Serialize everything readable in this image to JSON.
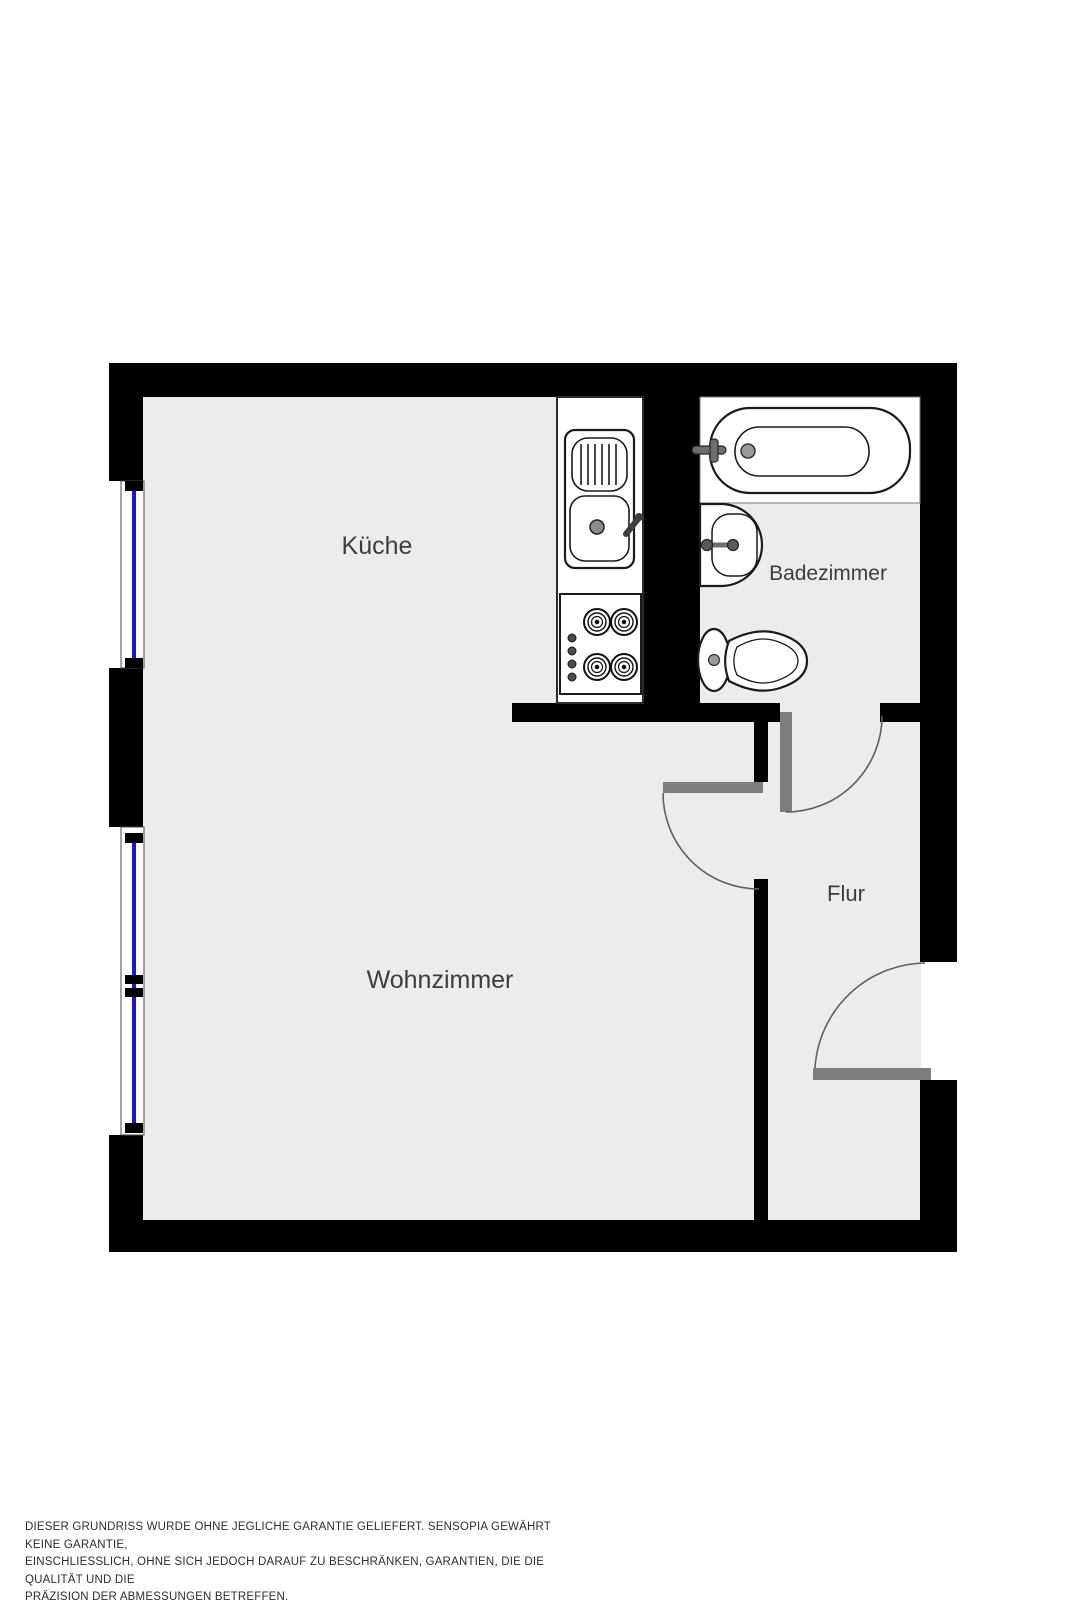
{
  "floorplan": {
    "rooms": [
      {
        "id": "kueche",
        "label": "Küche"
      },
      {
        "id": "badezimmer",
        "label": "Badezimmer"
      },
      {
        "id": "wohnzimmer",
        "label": "Wohnzimmer"
      },
      {
        "id": "flur",
        "label": "Flur"
      }
    ],
    "fixtures": [
      "bathtub",
      "bathroom-washbasin",
      "toilet",
      "kitchen-counter",
      "kitchen-sink-with-drainboard",
      "stove-4-burners"
    ],
    "window_count": 2,
    "door_count": 3,
    "colors": {
      "wall": "#000000",
      "floor": "#ececec",
      "window_glass": "#1717d4",
      "door_leaf": "#7d7d7d",
      "door_swing_arc": "#5f5f5f",
      "label_text": "#3d3d3d"
    }
  },
  "disclaimer": {
    "lines": [
      "DIESER GRUNDRISS WURDE OHNE JEGLICHE GARANTIE GELIEFERT. SENSOPIA GEWÄHRT KEINE GARANTIE,",
      "EINSCHLIESSLICH, OHNE SICH JEDOCH DARAUF ZU BESCHRÄNKEN, GARANTIEN, DIE DIE QUALITÄT UND DIE",
      "PRÄZISION DER ABMESSUNGEN BETREFFEN."
    ]
  }
}
